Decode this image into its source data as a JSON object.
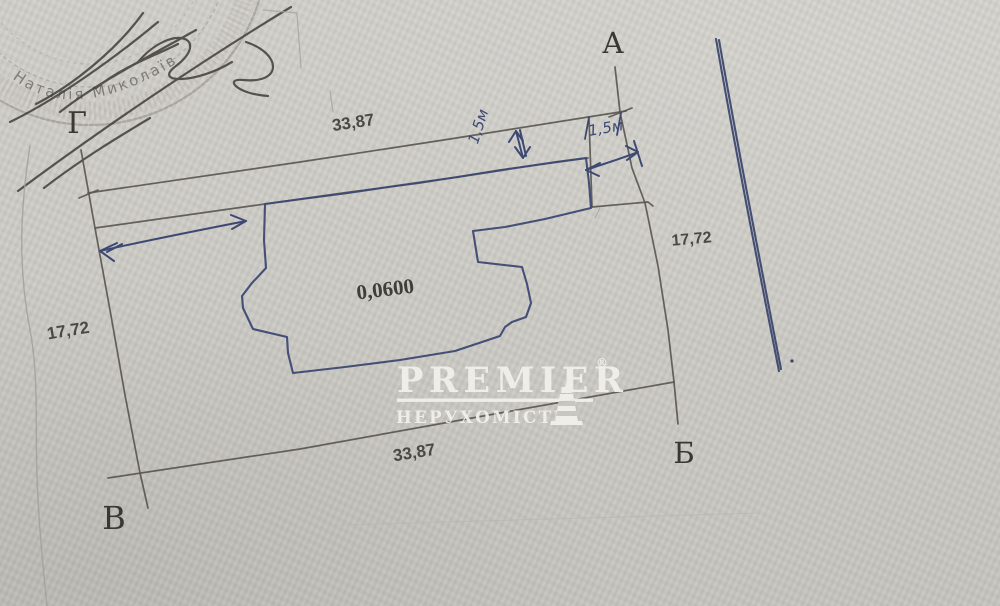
{
  "document": {
    "title": "Land plot survey sketch (scanned)"
  },
  "sketch": {
    "corners": {
      "top_left": "Г",
      "top_right": "А",
      "bottom_right": "Б",
      "bottom_left": "В"
    },
    "dims": {
      "top": "33,87",
      "bottom": "33,87",
      "left": "17,72",
      "right": "17,72"
    },
    "area": "0,0600",
    "ink_notes": {
      "setback_top": "1,5м",
      "setback_right": "1,5м"
    }
  },
  "stamp": {
    "ring_text": "Наталія Миколаїв"
  },
  "watermark": {
    "brand": "PREMIER",
    "reg": "®",
    "subtitle": "НЕРУХОМІСТЬ",
    "lighthouse_icon": "lighthouse"
  },
  "colors": {
    "paper": "#cbc9c3",
    "pencil": "#5a5751",
    "ink_blue": "#3d4973",
    "stamp_gray": "#8f8d86",
    "watermark_white": "#f2f0eb"
  }
}
